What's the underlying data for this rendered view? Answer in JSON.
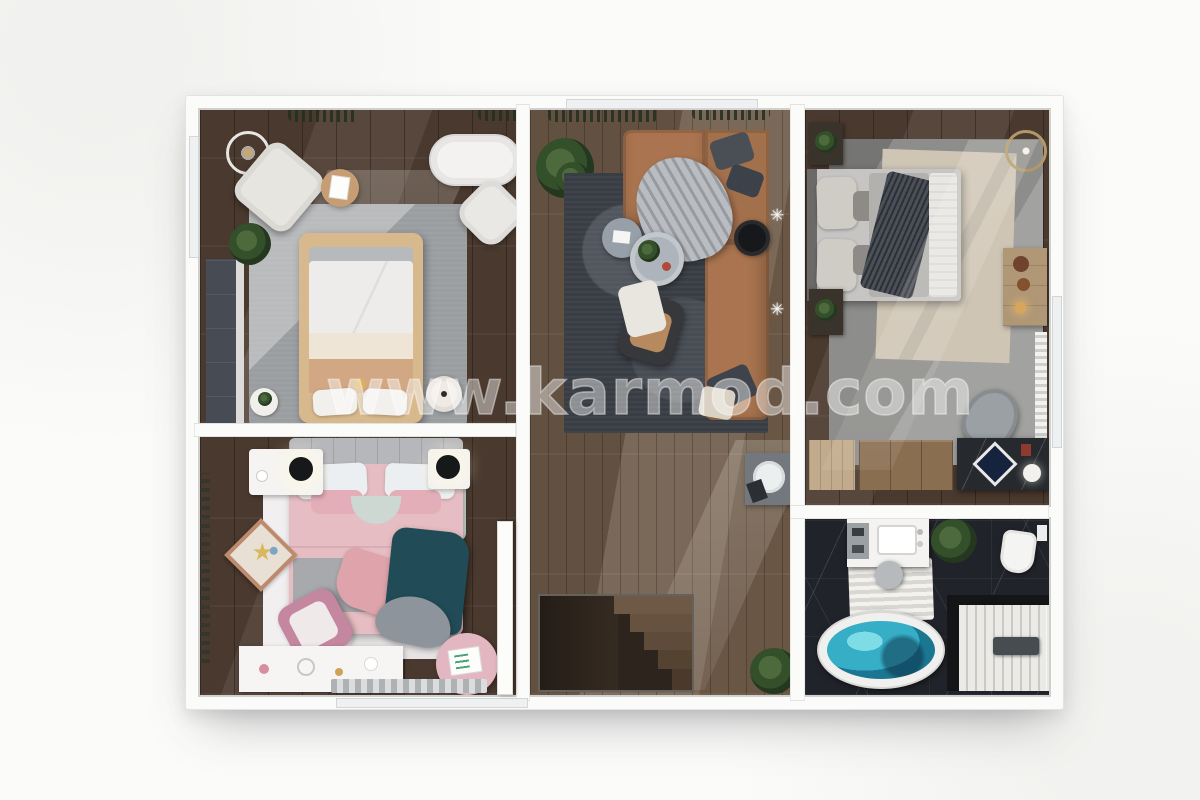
{
  "watermark": {
    "text": "www.karmod.com"
  },
  "scene": {
    "type": "3d-top-down-floor-plan-render",
    "rooms": [
      "bedroom-top-left",
      "bedroom-bottom-left",
      "living-room",
      "hallway-with-stairs",
      "bedroom-right",
      "bathroom"
    ]
  },
  "palette": {
    "background": "#fbfbf9",
    "wall_white": "#fbfbfa",
    "wood_dark": "#4a392e",
    "wood_mid": "#6d5947",
    "marble_black": "#202329",
    "rug_gray": "#9b9ea1",
    "rug_dark_living": "#393d44",
    "rug_light_pink_room": "#f2eff0",
    "sofa_leather_tan": "#a9744f",
    "bed_frame_tan": "#d8b98e",
    "bed_duvet_pink": "#e6bdc2",
    "throw_teal_dark": "#214c57",
    "bathtub_water_teal": "#35aec6",
    "accent_gold": "#b29869"
  }
}
